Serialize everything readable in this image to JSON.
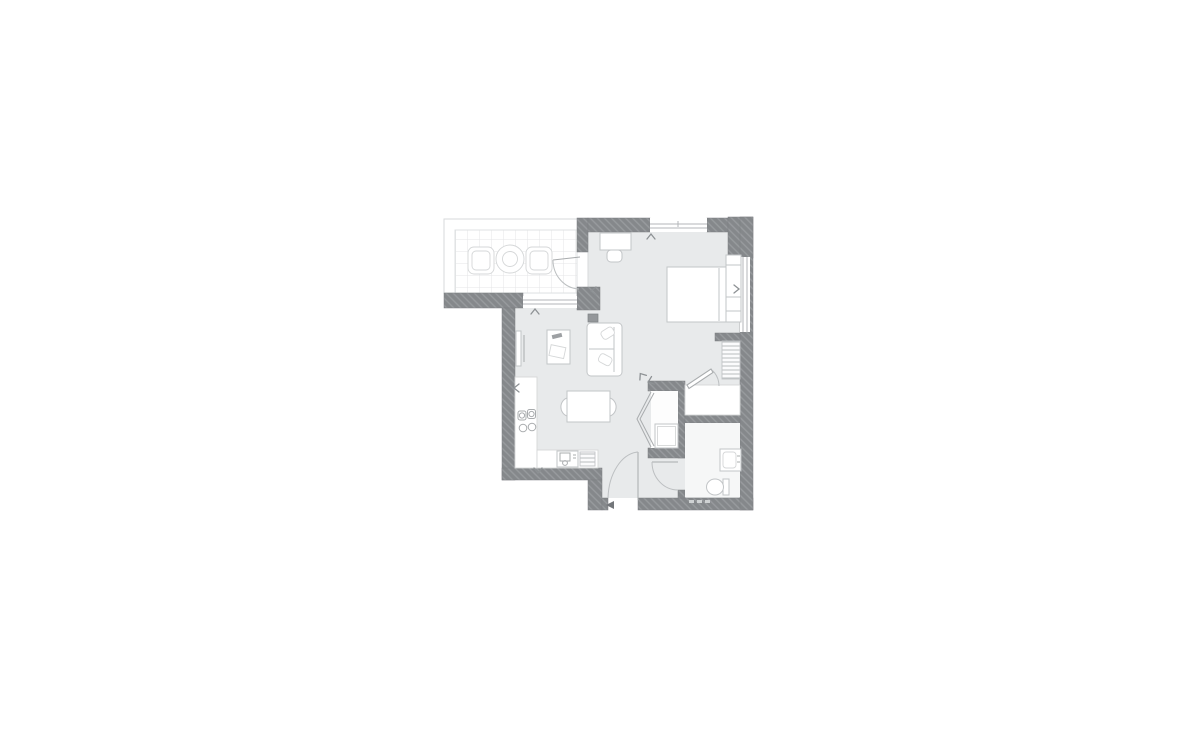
{
  "page": {
    "background": "#ffffff",
    "visible_text": ""
  },
  "floorplan": {
    "type": "residential-apartment-floor-plan",
    "style": "marketing plan, hatched grey walls on white, no text labels",
    "colors": {
      "wall": "#85888b",
      "wall_hatch": "#989b9e",
      "floor": "#e8eaeb",
      "fixture_outline": "#c2c5c7",
      "fixture_fill": "#ffffff",
      "detail": "#a9acae",
      "door_arc": "#bcbfc1",
      "marker": "#8d9194",
      "balcony_grid": "#e4e6e7"
    },
    "rooms": [
      {
        "name": "balcony",
        "features": [
          "tiled-floor-grid",
          "armchair-left",
          "round-table",
          "armchair-right",
          "balcony-door-swing"
        ]
      },
      {
        "name": "open-plan-living-kitchen-bedroom",
        "features": [
          "double-bed",
          "headboard-with-bedside-tables",
          "desk",
          "stool",
          "sofa",
          "two-cushions",
          "dark-side-table",
          "coffee-table-with-remote-and-magazine",
          "tv-unit",
          "dining-table",
          "two-dining-chairs",
          "kitchen-counter-L-shape",
          "four-zone-hob",
          "washing-machine",
          "striped-appliance"
        ]
      },
      {
        "name": "closet",
        "features": [
          "bi-fold-doors",
          "appliance-box"
        ]
      },
      {
        "name": "storage-cupboard",
        "features": [
          "outward-opening-door",
          "shelved-unit"
        ]
      },
      {
        "name": "bathroom",
        "features": [
          "washbasin-with-taps",
          "toilet-with-cistern",
          "door-swing",
          "threshold-dashes"
        ]
      },
      {
        "name": "entrance-hall",
        "features": [
          "entrance-door-swing",
          "entry-arrow"
        ]
      }
    ],
    "windows": [
      {
        "location": "top-wall-bedroom"
      },
      {
        "location": "right-wall-bedroom"
      },
      {
        "location": "left-living-wall-below-balcony"
      }
    ],
    "markers": {
      "chevron_count": 8,
      "entry_arrow": true
    }
  }
}
